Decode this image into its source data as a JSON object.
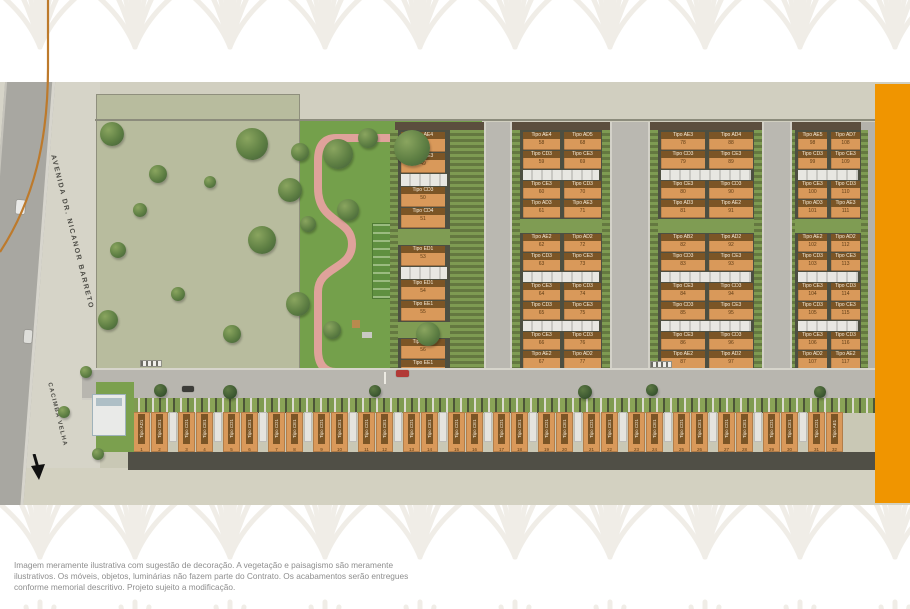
{
  "disclaimer": {
    "lines": [
      "Imagem meramente ilustrativa com sugestão de decoração. A vegetação e paisagismo são meramente",
      "ilustrativos. Os móveis, objetos, luminárias não fazem parte do Contrato. Os acabamentos serão entregues",
      "conforme memorial descritivo. Projeto sujeito a modificação."
    ]
  },
  "siteplan": {
    "street_labels": {
      "avenue": "AVENIDA DR. NICANOR BARRETO",
      "side": "CACIMBA VELHA"
    },
    "colors": {
      "accent_bar": "#F09500",
      "roof_orange": "#D9995A",
      "park_grass": "#74A04B",
      "park_path_pink": "#DFA29B",
      "deco_arc": "#BD7A2C"
    },
    "clusters": [
      {
        "id": "a",
        "rows": [
          {
            "t": "u",
            "cells": [
              {
                "label": "Tipo AE4",
                "num": "48"
              }
            ]
          },
          {
            "t": "u",
            "cells": [
              {
                "label": "Tipo CE3",
                "num": "49"
              }
            ]
          },
          {
            "t": "g"
          },
          {
            "t": "u",
            "cells": [
              {
                "label": "Tipo CD3",
                "num": "50"
              }
            ]
          },
          {
            "t": "u",
            "cells": [
              {
                "label": "Tipo CD4",
                "num": "51"
              }
            ]
          },
          {
            "t": "s"
          },
          {
            "t": "u",
            "cells": [
              {
                "label": "Tipo ED1",
                "num": "53"
              }
            ]
          },
          {
            "t": "g"
          },
          {
            "t": "u",
            "cells": [
              {
                "label": "Tipo ED1",
                "num": "54"
              }
            ]
          },
          {
            "t": "u",
            "cells": [
              {
                "label": "Tipo EE1",
                "num": "55"
              }
            ]
          },
          {
            "t": "s"
          },
          {
            "t": "u",
            "cells": [
              {
                "label": "Tipo ED1",
                "num": "56"
              }
            ]
          },
          {
            "t": "u",
            "cells": [
              {
                "label": "Tipo EE1",
                "num": "57"
              }
            ]
          }
        ]
      },
      {
        "id": "b",
        "rows": [
          {
            "t": "u",
            "cells": [
              {
                "label": "Tipo AE4",
                "num": "58"
              },
              {
                "label": "Tipo AD5",
                "num": "68"
              }
            ]
          },
          {
            "t": "u",
            "cells": [
              {
                "label": "Tipo CD3",
                "num": "59"
              },
              {
                "label": "Tipo CE3",
                "num": "69"
              }
            ]
          },
          {
            "t": "g"
          },
          {
            "t": "u",
            "cells": [
              {
                "label": "Tipo CE3",
                "num": "60"
              },
              {
                "label": "Tipo CD3",
                "num": "70"
              }
            ]
          },
          {
            "t": "u",
            "cells": [
              {
                "label": "Tipo AD3",
                "num": "61"
              },
              {
                "label": "Tipo AE3",
                "num": "71"
              }
            ]
          },
          {
            "t": "s"
          },
          {
            "t": "u",
            "cells": [
              {
                "label": "Tipo AE2",
                "num": "62"
              },
              {
                "label": "Tipo AD2",
                "num": "72"
              }
            ]
          },
          {
            "t": "u",
            "cells": [
              {
                "label": "Tipo CD3",
                "num": "63"
              },
              {
                "label": "Tipo CE3",
                "num": "73"
              }
            ]
          },
          {
            "t": "g"
          },
          {
            "t": "u",
            "cells": [
              {
                "label": "Tipo CE3",
                "num": "64"
              },
              {
                "label": "Tipo CD3",
                "num": "74"
              }
            ]
          },
          {
            "t": "u",
            "cells": [
              {
                "label": "Tipo CD3",
                "num": "65"
              },
              {
                "label": "Tipo CE3",
                "num": "75"
              }
            ]
          },
          {
            "t": "g"
          },
          {
            "t": "u",
            "cells": [
              {
                "label": "Tipo CE3",
                "num": "66"
              },
              {
                "label": "Tipo CD3",
                "num": "76"
              }
            ]
          },
          {
            "t": "u",
            "cells": [
              {
                "label": "Tipo AE2",
                "num": "67"
              },
              {
                "label": "Tipo AD2",
                "num": "77"
              }
            ]
          }
        ]
      },
      {
        "id": "c",
        "rows": [
          {
            "t": "u",
            "cells": [
              {
                "label": "Tipo AE3",
                "num": "78"
              },
              {
                "label": "Tipo AD4",
                "num": "88"
              }
            ]
          },
          {
            "t": "u",
            "cells": [
              {
                "label": "Tipo CD3",
                "num": "79"
              },
              {
                "label": "Tipo CE3",
                "num": "89"
              }
            ]
          },
          {
            "t": "g"
          },
          {
            "t": "u",
            "cells": [
              {
                "label": "Tipo CE3",
                "num": "80"
              },
              {
                "label": "Tipo CD3",
                "num": "90"
              }
            ]
          },
          {
            "t": "u",
            "cells": [
              {
                "label": "Tipo AD3",
                "num": "81"
              },
              {
                "label": "Tipo AE2",
                "num": "91"
              }
            ]
          },
          {
            "t": "s"
          },
          {
            "t": "u",
            "cells": [
              {
                "label": "Tipo AB2",
                "num": "82"
              },
              {
                "label": "Tipo AD2",
                "num": "92"
              }
            ]
          },
          {
            "t": "u",
            "cells": [
              {
                "label": "Tipo CD3",
                "num": "83"
              },
              {
                "label": "Tipo CE3",
                "num": "93"
              }
            ]
          },
          {
            "t": "g"
          },
          {
            "t": "u",
            "cells": [
              {
                "label": "Tipo CE3",
                "num": "84"
              },
              {
                "label": "Tipo CD3",
                "num": "94"
              }
            ]
          },
          {
            "t": "u",
            "cells": [
              {
                "label": "Tipo CD3",
                "num": "85"
              },
              {
                "label": "Tipo CE3",
                "num": "95"
              }
            ]
          },
          {
            "t": "g"
          },
          {
            "t": "u",
            "cells": [
              {
                "label": "Tipo CE3",
                "num": "86"
              },
              {
                "label": "Tipo CD3",
                "num": "96"
              }
            ]
          },
          {
            "t": "u",
            "cells": [
              {
                "label": "Tipo AE2",
                "num": "87"
              },
              {
                "label": "Tipo AD2",
                "num": "97"
              }
            ]
          }
        ]
      },
      {
        "id": "d",
        "rows": [
          {
            "t": "u",
            "cells": [
              {
                "label": "Tipo AE5",
                "num": "98"
              },
              {
                "label": "Tipo AD7",
                "num": "108"
              }
            ]
          },
          {
            "t": "u",
            "cells": [
              {
                "label": "Tipo CD3",
                "num": "99"
              },
              {
                "label": "Tipo CE3",
                "num": "109"
              }
            ]
          },
          {
            "t": "g"
          },
          {
            "t": "u",
            "cells": [
              {
                "label": "Tipo CE3",
                "num": "100"
              },
              {
                "label": "Tipo CD3",
                "num": "110"
              }
            ]
          },
          {
            "t": "u",
            "cells": [
              {
                "label": "Tipo AD3",
                "num": "101"
              },
              {
                "label": "Tipo AE3",
                "num": "111"
              }
            ]
          },
          {
            "t": "s"
          },
          {
            "t": "u",
            "cells": [
              {
                "label": "Tipo AE2",
                "num": "102"
              },
              {
                "label": "Tipo AD2",
                "num": "112"
              }
            ]
          },
          {
            "t": "u",
            "cells": [
              {
                "label": "Tipo CD3",
                "num": "103"
              },
              {
                "label": "Tipo CE3",
                "num": "113"
              }
            ]
          },
          {
            "t": "g"
          },
          {
            "t": "u",
            "cells": [
              {
                "label": "Tipo CE3",
                "num": "104"
              },
              {
                "label": "Tipo CD3",
                "num": "114"
              }
            ]
          },
          {
            "t": "u",
            "cells": [
              {
                "label": "Tipo CD3",
                "num": "105"
              },
              {
                "label": "Tipo CE3",
                "num": "115"
              }
            ]
          },
          {
            "t": "g"
          },
          {
            "t": "u",
            "cells": [
              {
                "label": "Tipo CE3",
                "num": "106"
              },
              {
                "label": "Tipo CD3",
                "num": "116"
              }
            ]
          },
          {
            "t": "u",
            "cells": [
              {
                "label": "Tipo AD2",
                "num": "107"
              },
              {
                "label": "Tipo AE2",
                "num": "117"
              }
            ]
          }
        ]
      }
    ],
    "bottom_row": {
      "houses": [
        {
          "label": "Tipo AD1",
          "num": "1"
        },
        {
          "label": "Tipo CE1",
          "num": "2"
        },
        {
          "label": "Tipo CD1",
          "num": "3"
        },
        {
          "label": "Tipo CE1",
          "num": "4"
        },
        {
          "label": "Tipo CD1",
          "num": "5"
        },
        {
          "label": "Tipo CE1",
          "num": "6"
        },
        {
          "label": "Tipo CD1",
          "num": "7"
        },
        {
          "label": "Tipo CE1",
          "num": "8"
        },
        {
          "label": "Tipo CD1",
          "num": "9"
        },
        {
          "label": "Tipo CE1",
          "num": "10"
        },
        {
          "label": "Tipo CD1",
          "num": "11"
        },
        {
          "label": "Tipo CE1",
          "num": "12"
        },
        {
          "label": "Tipo CD1",
          "num": "13"
        },
        {
          "label": "Tipo CE1",
          "num": "14"
        },
        {
          "label": "Tipo CD1",
          "num": "15"
        },
        {
          "label": "Tipo CE1",
          "num": "16"
        },
        {
          "label": "Tipo CD1",
          "num": "17"
        },
        {
          "label": "Tipo CE1",
          "num": "18"
        },
        {
          "label": "Tipo CD1",
          "num": "19"
        },
        {
          "label": "Tipo CE1",
          "num": "20"
        },
        {
          "label": "Tipo CD1",
          "num": "21"
        },
        {
          "label": "Tipo CE1",
          "num": "22"
        },
        {
          "label": "Tipo CD1",
          "num": "23"
        },
        {
          "label": "Tipo CE1",
          "num": "24"
        },
        {
          "label": "Tipo CD1",
          "num": "25"
        },
        {
          "label": "Tipo CE1",
          "num": "26"
        },
        {
          "label": "Tipo CD1",
          "num": "27"
        },
        {
          "label": "Tipo CE1",
          "num": "28"
        },
        {
          "label": "Tipo CD1",
          "num": "29"
        },
        {
          "label": "Tipo CE1",
          "num": "30"
        },
        {
          "label": "Tipo CD1",
          "num": "31"
        },
        {
          "label": "Tipo AE1",
          "num": "32"
        }
      ]
    }
  }
}
